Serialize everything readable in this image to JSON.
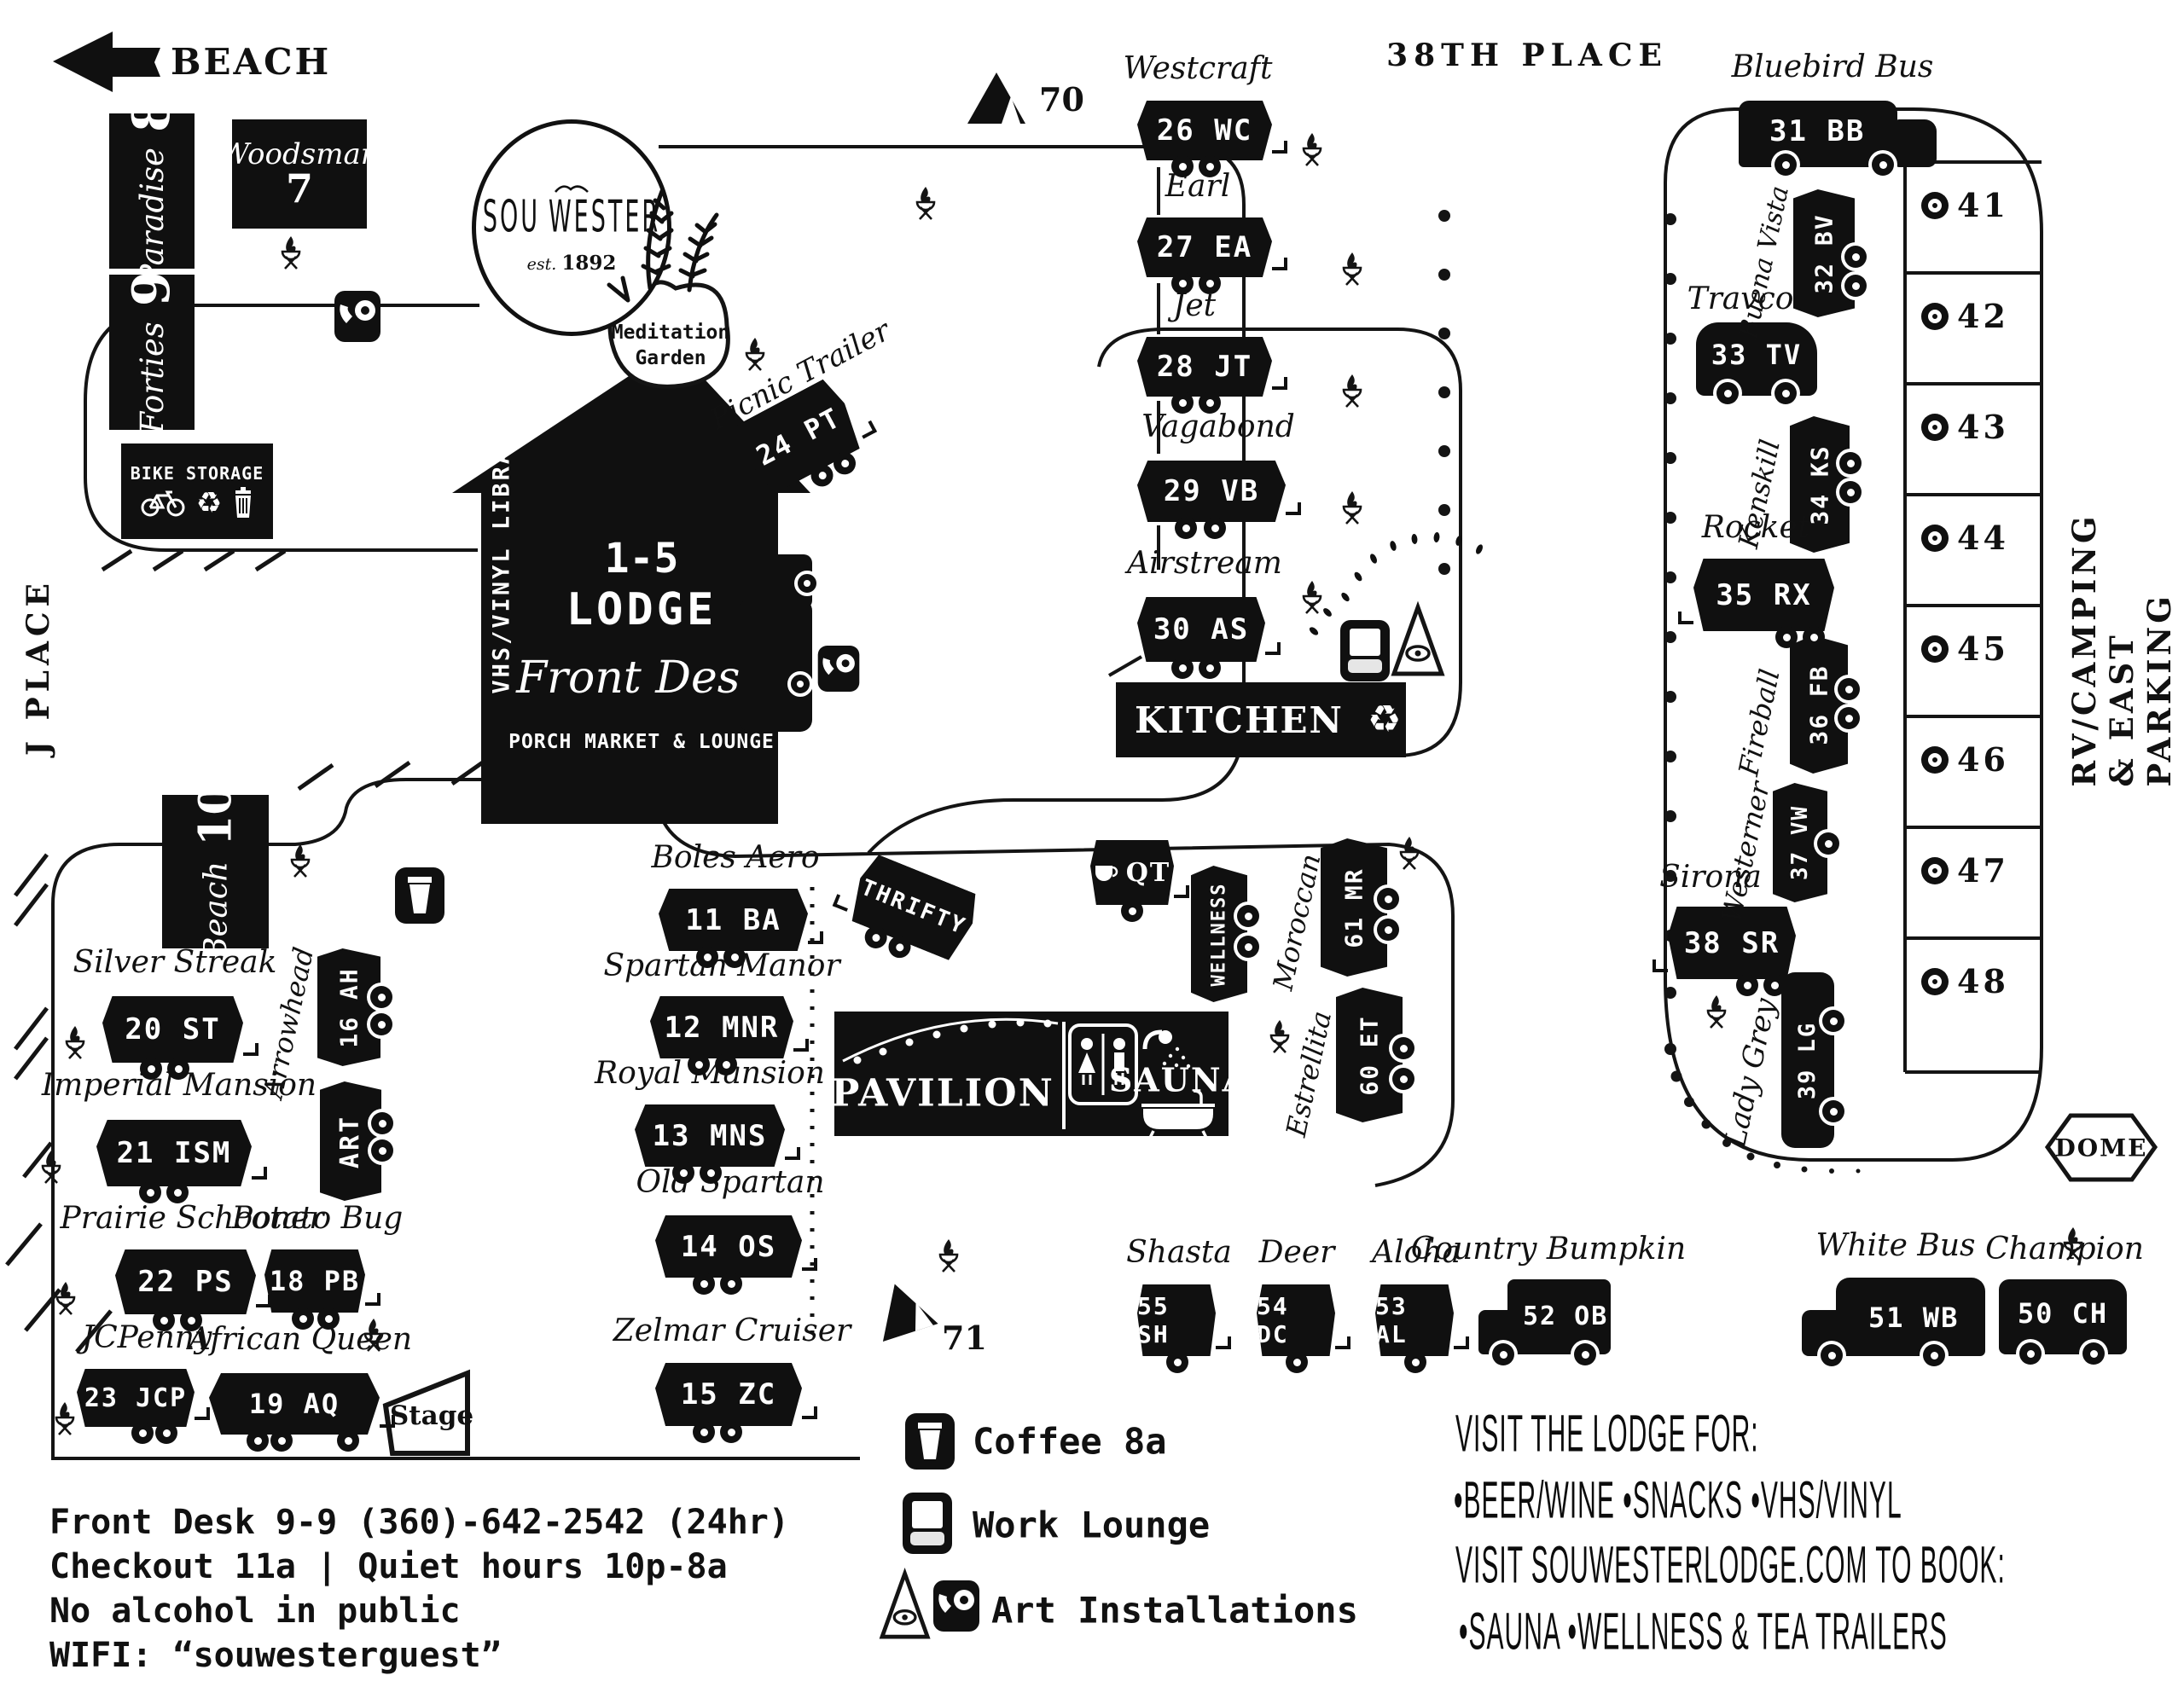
{
  "streets": {
    "beach": "BEACH",
    "thirty_eighth": "38TH PLACE",
    "j_place": "J PLACE",
    "rv_camping": "RV/CAMPING & EAST PARKING"
  },
  "logo": {
    "sou": "SOU",
    "wester": "WESTER",
    "est": "est.",
    "year": "1892"
  },
  "lodge": {
    "units": "1-5",
    "name": "LODGE",
    "front_desk": "Front Desk",
    "porch": "PORCH MARKET & LOUNGE",
    "library": "VHS/VINYL LIBRARY"
  },
  "features": {
    "meditation_1": "Meditation",
    "meditation_2": "Garden",
    "bike_storage": "BIKE STORAGE",
    "kitchen": "KITCHEN",
    "pavilion": "PAVILION",
    "sauna": "SAUNA",
    "stage": "Stage",
    "dome": "DOME",
    "micro_1": "Micro",
    "micro_2": "Theatre 5-9p",
    "tent_70": "70",
    "tent_71": "71"
  },
  "trailers": [
    {
      "name": "Paradise",
      "code": "8"
    },
    {
      "name": "Forties",
      "code": "9"
    },
    {
      "name": "Woodsman",
      "code": "7"
    },
    {
      "name": "Beach",
      "code": "10"
    },
    {
      "name": "Picnic Trailer",
      "code": "24 PT"
    },
    {
      "name": "Westcraft",
      "code": "26 WC"
    },
    {
      "name": "Earl",
      "code": "27 EA"
    },
    {
      "name": "Jet",
      "code": "28 JT"
    },
    {
      "name": "Vagabond",
      "code": "29 VB"
    },
    {
      "name": "Airstream",
      "code": "30 AS"
    },
    {
      "name": "Bluebird Bus",
      "code": "31 BB"
    },
    {
      "name": "Buena Vista",
      "code": "32 BV"
    },
    {
      "name": "Travco",
      "code": "33 TV"
    },
    {
      "name": "Kenskill",
      "code": "34 KS"
    },
    {
      "name": "Rocket",
      "code": "35 RX"
    },
    {
      "name": "Fireball",
      "code": "36 FB"
    },
    {
      "name": "Westerner",
      "code": "37 VW"
    },
    {
      "name": "Sirona",
      "code": "38 SR"
    },
    {
      "name": "Lady Grey",
      "code": "39 LG"
    },
    {
      "name": "Boles Aero",
      "code": "11 BA"
    },
    {
      "name": "Spartan Manor",
      "code": "12 MNR"
    },
    {
      "name": "Royal Mansion",
      "code": "13 MNS"
    },
    {
      "name": "Old Spartan",
      "code": "14 OS"
    },
    {
      "name": "Zelmar Cruiser",
      "code": "15 ZC"
    },
    {
      "name": "Silver Streak",
      "code": "20 ST"
    },
    {
      "name": "Arrowhead",
      "code": "16 AH"
    },
    {
      "name": "Art",
      "code": "ART"
    },
    {
      "name": "Imperial Mansion",
      "code": "21 ISM"
    },
    {
      "name": "Prairie Schooner",
      "code": "22 PS"
    },
    {
      "name": "Potato Bug",
      "code": "18 PB"
    },
    {
      "name": "JCPenny",
      "code": "23 JCP"
    },
    {
      "name": "African Queen",
      "code": "19 AQ"
    },
    {
      "name": "Moroccan",
      "code": "61 MR"
    },
    {
      "name": "Estrellita",
      "code": "60 ET"
    },
    {
      "name": "Shasta",
      "code": "55 SH"
    },
    {
      "name": "Deer",
      "code": "54 DC"
    },
    {
      "name": "Aloha",
      "code": "53 AL"
    },
    {
      "name": "Country Bumpkin",
      "code": "52 OB"
    },
    {
      "name": "White Bus",
      "code": "51 WB"
    },
    {
      "name": "Champion",
      "code": "50 CH"
    },
    {
      "name": "QT",
      "code": "QT"
    },
    {
      "name": "Wellness",
      "code": "WELLNESS"
    },
    {
      "name": "Thrifty",
      "code": "THRIFTY"
    }
  ],
  "parking": {
    "stalls": [
      "41",
      "42",
      "43",
      "44",
      "45",
      "46",
      "47",
      "48"
    ]
  },
  "legend": [
    {
      "label": "Coffee 8a"
    },
    {
      "label": "Work Lounge"
    },
    {
      "label": "Art Installations"
    }
  ],
  "info_lines": [
    "Front Desk 9-9 (360)-642-2542 (24hr)",
    "Checkout 11a | Quiet hours 10p-8a",
    "No alcohol in public",
    "WIFI: “souwesterguest”"
  ],
  "promo_lines": [
    "VISIT THE LODGE FOR:",
    "•BEER/WINE •SNACKS •VHS/VINYL",
    "VISIT SOUWESTERLODGE.COM TO BOOK:",
    "•SAUNA •WELLNESS & TEA TRAILERS"
  ],
  "colors": {
    "ink": "#101010",
    "paper": "#ffffff"
  }
}
